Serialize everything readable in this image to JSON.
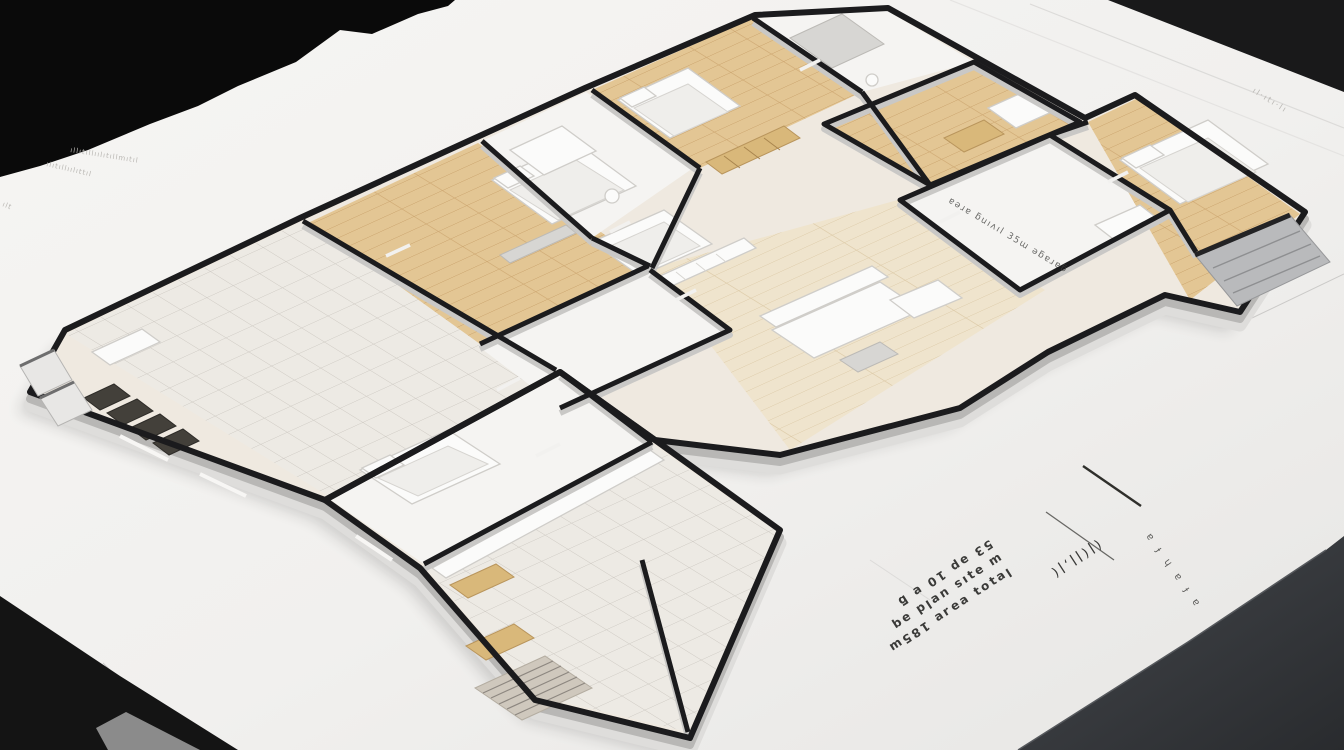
{
  "scene": {
    "description": "3D isometric architectural floor plan model rendered on a white blueprint sheet lying on a dark desk",
    "sheet": "white paper with torn upper-left edge and faint creases",
    "view": "high-angle axonometric, model rotated toward upper right"
  },
  "colors": {
    "paper": "#f2f1ef",
    "bg_dark": "#0a0a0a",
    "bg_dark2": "#1a1a1b",
    "desk": "#3a3d41",
    "wall_cap": "#1b1b1d",
    "wall_side": "#b8b7b5",
    "wall_base": "#dedddb",
    "wood": "#e3c694",
    "wood_line": "#c8a069",
    "wood_pale": "#efe4cd",
    "tile": "#edeae4",
    "tile_line": "#ccc8c1",
    "floor_white": "#f5f4f2",
    "furniture": "#fbfbfa",
    "furniture_line": "#cfcdc9",
    "accent_wood": "#d9b87a",
    "chair_dark": "#43403a",
    "annotation": "#3a3a38",
    "faint": "#b8b6b2"
  },
  "annotations": {
    "room_label": "ɐǝɹɐ ƃuıʌıl 35ɯ ǝƃɐɹɐƃ",
    "note_block": {
      "lines": [
        "lɐʇoʇ ɐǝɹɐ 185ɯ",
        "ɯ ǝʇıs uɐld ǝq",
        "53 ǝp 10 ɐ ƃ"
      ],
      "marks": "(ǀ(ǀǀ‚ǀ(",
      "column": "ɐ ɟ ɥ ɐ ɟ ɐ"
    },
    "corner_faint": "ıl·ıtı·lı",
    "scribbles": [
      "ıllıtıllıılıtıllmıtıl",
      "ılıtıllıılıttıl",
      "ılt"
    ]
  },
  "model": {
    "rooms": [
      {
        "name": "lounge-left-wing",
        "floor": "tile"
      },
      {
        "name": "bedroom-left",
        "floor": "wood"
      },
      {
        "name": "bathroom-center",
        "floor": "white"
      },
      {
        "name": "hallway",
        "floor": "white"
      },
      {
        "name": "bedroom-lower-center",
        "floor": "white"
      },
      {
        "name": "kitchen-dining-wing",
        "floor": "tile"
      },
      {
        "name": "bedroom-top-center",
        "floor": "wood"
      },
      {
        "name": "bathroom-top-right",
        "floor": "white"
      },
      {
        "name": "bedroom-northeast",
        "floor": "wood"
      },
      {
        "name": "annotated-white-room",
        "floor": "white"
      },
      {
        "name": "bedroom-east",
        "floor": "wood"
      },
      {
        "name": "living-room",
        "floor": "pale-wood"
      }
    ],
    "furniture": [
      "beds",
      "sofa-set",
      "dining-chairs",
      "stairs",
      "wardrobe",
      "bathtub",
      "tables"
    ]
  }
}
